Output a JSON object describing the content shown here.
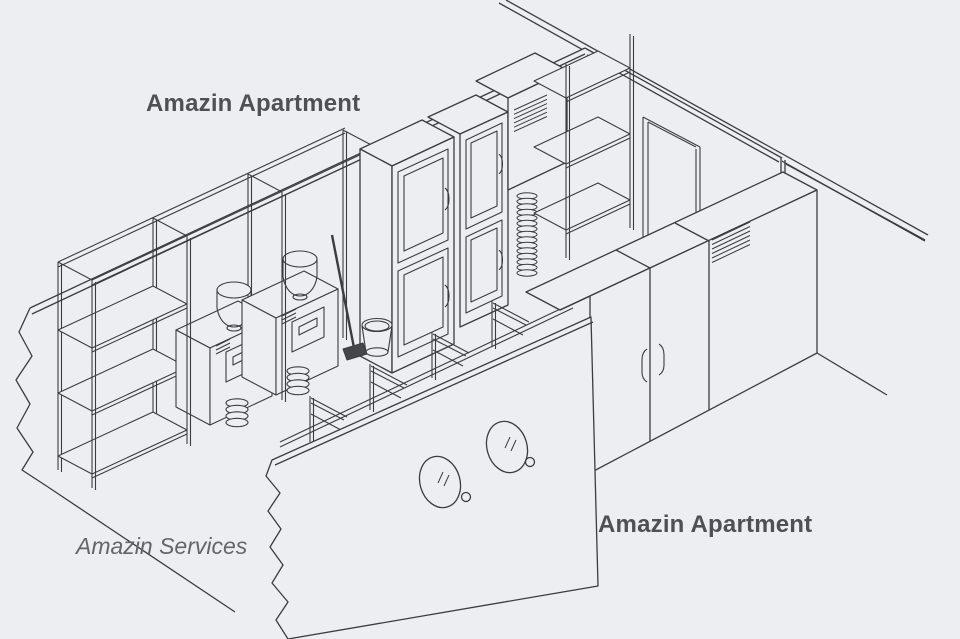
{
  "labels": {
    "apartment_top": "Amazin Apartment",
    "services": "Amazin Services",
    "apartment_bottom": "Amazin Apartment"
  },
  "colors": {
    "background": "#edeef2",
    "line": "#3a3c42",
    "label_bold": "#4e5056",
    "label_italic": "#63656b",
    "mop_head": "#44464c"
  },
  "scene_objects": [
    "ceiling-edge",
    "right-wall-with-door",
    "door-frame",
    "left-wall-cutaway",
    "storage-shelf-rack",
    "washer-machine-1",
    "washer-machine-2",
    "funnel-tub-1",
    "funnel-tub-2",
    "drain-hose-1",
    "drain-hose-2",
    "tall-cabinet-1",
    "tall-cabinet-2",
    "vent-box",
    "corrugated-duct",
    "wall-shelf-unit",
    "wardrobe-counter",
    "wardrobe-vent-grille",
    "door-handles",
    "bench-frame-1",
    "bench-frame-2",
    "bench-frame-3",
    "bench-frame-4",
    "bench-rail",
    "bucket",
    "mop",
    "porthole-wall",
    "porthole-window-1",
    "porthole-window-2"
  ]
}
